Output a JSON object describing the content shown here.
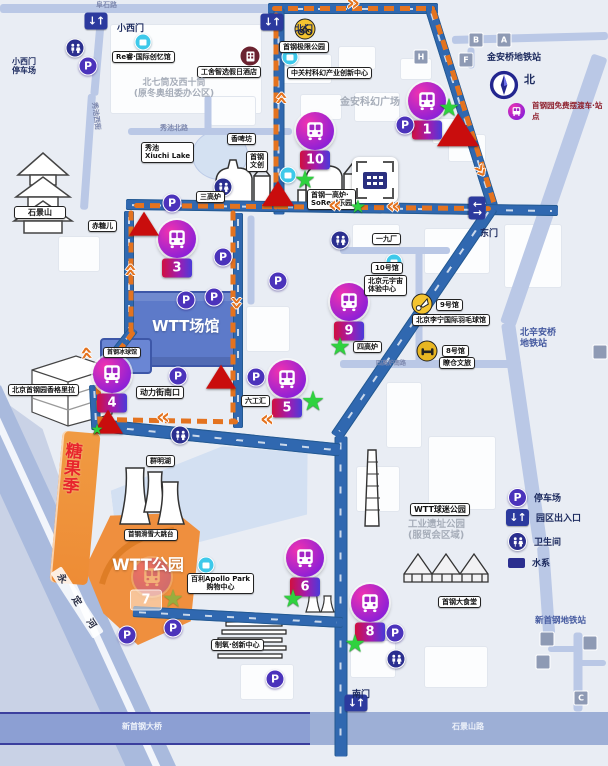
{
  "legend": {
    "compass_label": "北",
    "shuttle_stop_label": "首钢园免费摆渡车·站点",
    "items": [
      {
        "icon": "parking-icon",
        "label": "停车场"
      },
      {
        "icon": "gate-icon",
        "label": "园区出入口"
      },
      {
        "icon": "restroom-icon",
        "label": "卫生间"
      },
      {
        "icon": "water-icon",
        "label": "水系"
      }
    ]
  },
  "gates": [
    {
      "label": "北门",
      "ix": 272,
      "iy": 22,
      "tx": 295,
      "ty": 25
    },
    {
      "label": "小西门",
      "ix": 96,
      "iy": 21,
      "tx": 117,
      "ty": 24
    },
    {
      "label": "东门",
      "ix": 477,
      "iy": 208,
      "tx": 480,
      "ty": 229,
      "rot": 90
    },
    {
      "label": "南门",
      "ix": 356,
      "iy": 703,
      "tx": 352,
      "ty": 690
    }
  ],
  "stops": [
    {
      "n": "1",
      "x": 427,
      "y": 101
    },
    {
      "n": "10",
      "x": 315,
      "y": 131
    },
    {
      "n": "3",
      "x": 177,
      "y": 239
    },
    {
      "n": "9",
      "x": 349,
      "y": 302
    },
    {
      "n": "4",
      "x": 112,
      "y": 374
    },
    {
      "n": "5",
      "x": 287,
      "y": 379
    },
    {
      "n": "6",
      "x": 305,
      "y": 558
    },
    {
      "n": "8",
      "x": 370,
      "y": 603
    },
    {
      "n": "7",
      "x": 152,
      "y": 577,
      "faded": true,
      "by": 600,
      "bx": 146
    }
  ],
  "labels": [
    {
      "text": "阜石路",
      "x": 96,
      "y": 1,
      "cls": "roadname",
      "fs": 7
    },
    {
      "lines": [
        "小西门",
        "停车场"
      ],
      "x": 12,
      "y": 57,
      "cls": "navy",
      "fs": 8
    },
    {
      "text": "Re睿·国际创忆馆",
      "x": 112,
      "y": 51,
      "cls": "box-sm"
    },
    {
      "text": "工舍智选假日酒店",
      "x": 197,
      "y": 66,
      "cls": "box-sm"
    },
    {
      "lines": [
        "北七筒及西十筒",
        "(原冬奥组委办公区)"
      ],
      "x": 118,
      "y": 78,
      "cls": "gray",
      "fs": 9,
      "w": 112,
      "center": true
    },
    {
      "text": "秀池北路",
      "x": 160,
      "y": 124,
      "cls": "roadname",
      "fs": 7
    },
    {
      "text": "秀池西街",
      "x": 82,
      "y": 112,
      "cls": "roadname",
      "fs": 7,
      "rot": 83
    },
    {
      "lines": [
        "秀池",
        "Xiuchi Lake"
      ],
      "x": 141,
      "y": 142,
      "cls": "box-sm"
    },
    {
      "text": "香啤坊",
      "x": 227,
      "y": 133,
      "cls": "box-sm"
    },
    {
      "lines": [
        "首钢",
        "文创"
      ],
      "x": 246,
      "y": 151,
      "cls": "box-sm"
    },
    {
      "text": "三高炉",
      "x": 196,
      "y": 191,
      "cls": "box-sm"
    },
    {
      "text": "石景山",
      "x": 14,
      "y": 206,
      "cls": "box",
      "w": 44,
      "center": true
    },
    {
      "text": "赤糖儿",
      "x": 88,
      "y": 220,
      "cls": "box-sm"
    },
    {
      "text": "首钢极限公园",
      "x": 279,
      "y": 41,
      "cls": "box-sm"
    },
    {
      "text": "中关村科幻产业创新中心",
      "x": 287,
      "y": 67,
      "cls": "box-sm"
    },
    {
      "text": "金安科幻广场",
      "x": 340,
      "y": 97,
      "cls": "gray",
      "fs": 10
    },
    {
      "text": "金安桥地铁站",
      "x": 487,
      "y": 53,
      "cls": "navy",
      "fs": 9
    },
    {
      "lines": [
        "首钢一高炉·",
        "SoReal乐园"
      ],
      "x": 307,
      "y": 189,
      "cls": "box-sm"
    },
    {
      "text": "一九厂",
      "x": 372,
      "y": 233,
      "cls": "box-sm"
    },
    {
      "text": "10号馆",
      "x": 371,
      "y": 262,
      "cls": "box-sm"
    },
    {
      "lines": [
        "北京元宇宙",
        "体验中心"
      ],
      "x": 364,
      "y": 275,
      "cls": "box-sm"
    },
    {
      "text": "9号馆",
      "x": 436,
      "y": 299,
      "cls": "box-sm"
    },
    {
      "text": "北京李宁国际羽毛球馆",
      "x": 412,
      "y": 314,
      "cls": "box-sm"
    },
    {
      "text": "8号馆",
      "x": 442,
      "y": 345,
      "cls": "box-sm"
    },
    {
      "text": "瞭仓文旅",
      "x": 439,
      "y": 357,
      "cls": "box-sm"
    },
    {
      "text": "四高炉",
      "x": 353,
      "y": 341,
      "cls": "box-sm"
    },
    {
      "text": "四高炉南路",
      "x": 376,
      "y": 360,
      "cls": "roadname",
      "fs": 6
    },
    {
      "lines": [
        "北辛安桥",
        "地铁站"
      ],
      "x": 520,
      "y": 328,
      "cls": "blue",
      "fs": 9
    },
    {
      "text": "WTT场馆",
      "x": 152,
      "y": 318,
      "cls": "white",
      "fs": 15
    },
    {
      "text": "首钢冰球馆",
      "x": 103,
      "y": 347,
      "cls": "box-sm",
      "fs": 6
    },
    {
      "text": "北京首钢园香格里拉",
      "x": 8,
      "y": 384,
      "cls": "box-sm"
    },
    {
      "text": "动力街南口",
      "x": 136,
      "y": 386,
      "cls": "box"
    },
    {
      "text": "六工汇",
      "x": 241,
      "y": 395,
      "cls": "box-sm"
    },
    {
      "text": "群明湖",
      "x": 146,
      "y": 455,
      "cls": "box-sm"
    },
    {
      "lines": [
        "糖",
        "果",
        "季"
      ],
      "x": 64,
      "y": 444,
      "cls": "candy",
      "rot": 5
    },
    {
      "text": "WTT公园",
      "x": 112,
      "y": 556,
      "cls": "white",
      "fs": 16
    },
    {
      "text": "首钢滑雪大跳台",
      "x": 124,
      "y": 529,
      "cls": "box-sm",
      "fs": 6.5
    },
    {
      "lines": [
        "百利Apollo Park",
        "购物中心"
      ],
      "x": 187,
      "y": 573,
      "cls": "box-sm",
      "center": true
    },
    {
      "text": "制氧·创新中心",
      "x": 211,
      "y": 639,
      "cls": "box-sm"
    },
    {
      "text": "永 定 河",
      "x": 38,
      "y": 596,
      "cls": "river",
      "rot": 57
    },
    {
      "text": "WTT球迷公园",
      "x": 410,
      "y": 503,
      "cls": "box"
    },
    {
      "lines": [
        "工业遗址公园",
        "(服贸会区域)"
      ],
      "x": 408,
      "y": 519,
      "cls": "gray",
      "fs": 9.5
    },
    {
      "text": "首钢大食堂",
      "x": 438,
      "y": 596,
      "cls": "box-sm"
    },
    {
      "text": "新首钢地铁站",
      "x": 535,
      "y": 616,
      "cls": "blue",
      "fs": 8.5
    },
    {
      "text": "新首钢大桥",
      "x": 122,
      "y": 722,
      "cls": "roadwhite"
    },
    {
      "text": "石景山路",
      "x": 452,
      "y": 722,
      "cls": "roadwhite"
    }
  ],
  "markers": {
    "parking": [
      {
        "x": 88,
        "y": 66
      },
      {
        "x": 172,
        "y": 203
      },
      {
        "x": 223,
        "y": 257
      },
      {
        "x": 278,
        "y": 281
      },
      {
        "x": 186,
        "y": 300
      },
      {
        "x": 214,
        "y": 297
      },
      {
        "x": 405,
        "y": 125
      },
      {
        "x": 178,
        "y": 376
      },
      {
        "x": 256,
        "y": 377
      },
      {
        "x": 127,
        "y": 635
      },
      {
        "x": 173,
        "y": 628
      },
      {
        "x": 275,
        "y": 679
      },
      {
        "x": 395,
        "y": 633
      }
    ],
    "restroom": [
      {
        "x": 75,
        "y": 48
      },
      {
        "x": 223,
        "y": 187
      },
      {
        "x": 340,
        "y": 240
      },
      {
        "x": 180,
        "y": 435
      },
      {
        "x": 396,
        "y": 659
      }
    ],
    "info": [
      {
        "x": 143,
        "y": 42
      },
      {
        "x": 290,
        "y": 57
      },
      {
        "x": 288,
        "y": 175
      },
      {
        "x": 394,
        "y": 262
      },
      {
        "x": 206,
        "y": 565
      }
    ],
    "star": [
      {
        "x": 449,
        "y": 109
      },
      {
        "x": 305,
        "y": 181
      },
      {
        "x": 358,
        "y": 208,
        "s": 18
      },
      {
        "x": 340,
        "y": 348
      },
      {
        "x": 313,
        "y": 403,
        "s": 27
      },
      {
        "x": 293,
        "y": 600
      },
      {
        "x": 355,
        "y": 645
      },
      {
        "x": 97,
        "y": 431,
        "s": 14
      },
      {
        "x": 173,
        "y": 600,
        "faded": true
      }
    ],
    "triangle": [
      {
        "x": 458,
        "y": 133,
        "s": 21
      },
      {
        "x": 278,
        "y": 196,
        "s": 16
      },
      {
        "x": 144,
        "y": 226,
        "s": 15
      },
      {
        "x": 221,
        "y": 379,
        "s": 15
      },
      {
        "x": 108,
        "y": 424,
        "s": 15
      }
    ],
    "exit": [
      {
        "t": "B",
        "x": 476,
        "y": 40
      },
      {
        "t": "A",
        "x": 504,
        "y": 40
      },
      {
        "t": "F",
        "x": 466,
        "y": 60
      },
      {
        "t": "H",
        "x": 421,
        "y": 57
      },
      {
        "t": "",
        "x": 547,
        "y": 639
      },
      {
        "t": "",
        "x": 543,
        "y": 662
      },
      {
        "t": "",
        "x": 590,
        "y": 643
      },
      {
        "t": "C",
        "x": 581,
        "y": 698
      },
      {
        "t": "",
        "x": 600,
        "y": 352
      }
    ],
    "special": [
      {
        "k": "bike-icon",
        "x": 305,
        "y": 29
      },
      {
        "k": "hotel-icon",
        "x": 250,
        "y": 56
      },
      {
        "k": "badminton-icon",
        "x": 422,
        "y": 304
      },
      {
        "k": "gym-icon",
        "x": 427,
        "y": 351
      },
      {
        "k": "furnace-viewpoint-icon",
        "x": 375,
        "y": 180
      }
    ],
    "chevron": [
      {
        "x": 352,
        "y": 4,
        "r": 0
      },
      {
        "x": 282,
        "y": 99,
        "r": -90
      },
      {
        "x": 336,
        "y": 205,
        "r": 180
      },
      {
        "x": 394,
        "y": 206,
        "r": 180
      },
      {
        "x": 480,
        "y": 170,
        "r": 60
      },
      {
        "x": 131,
        "y": 271,
        "r": -90
      },
      {
        "x": 87,
        "y": 354,
        "r": -95
      },
      {
        "x": 236,
        "y": 302,
        "r": 90
      },
      {
        "x": 164,
        "y": 417,
        "r": 180
      },
      {
        "x": 268,
        "y": 419,
        "r": 180
      }
    ]
  },
  "colors": {
    "route_orange": "#e4731f",
    "main_road_blue": "#3068b0",
    "stop_magenta": "#f032b0",
    "stop_purple": "#8a1fd8",
    "badge_red": "#cf1040",
    "badge_blue": "#4a3bd8",
    "star_green": "#2fd23f",
    "alert_red": "#c90d0d",
    "park_orange": "#ef8f3e",
    "venue_blue": "#5d7ac9"
  }
}
